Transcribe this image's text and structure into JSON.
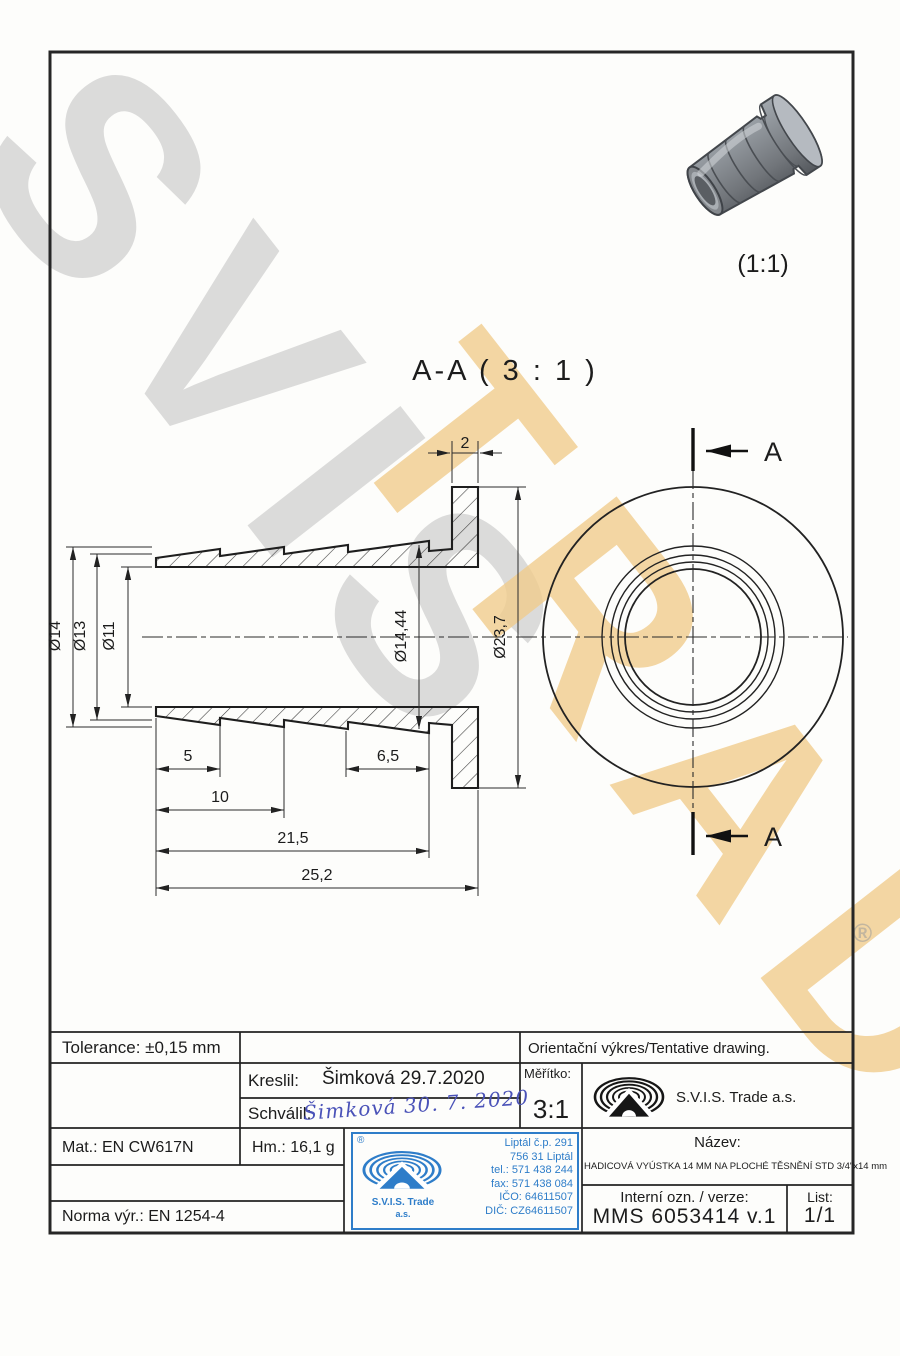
{
  "watermark": {
    "text_primary": "SVIS",
    "text_secondary": "TRADE",
    "registered": "®"
  },
  "views": {
    "section_title": "A-A ( 3 : 1 )",
    "photo_scale": "(1:1)",
    "cut_label_top": "A",
    "cut_label_bottom": "A"
  },
  "dimensions": {
    "flange_thickness": "2",
    "dia_outer": "Ø14",
    "dia_mid": "Ø13",
    "dia_bore": "Ø11",
    "dia_barb": "Ø14,44",
    "dia_flange": "Ø23,7",
    "len_5": "5",
    "len_10": "10",
    "len_6_5": "6,5",
    "len_21_5": "21,5",
    "len_25_2": "25,2"
  },
  "title_block": {
    "tolerance": "Tolerance: ±0,15 mm",
    "orientation_note": "Orientační výkres/Tentative drawing.",
    "kreslil_label": "Kreslil:",
    "kreslil_value": "Šimková 29.7.2020",
    "schvalil_label": "Schválil:",
    "schvalil_signature": "Šimková 30. 7. 2020",
    "meritko_label": "Měřítko:",
    "meritko_value": "3:1",
    "company": "S.V.I.S. Trade a.s.",
    "mat": "Mat.: EN CW617N",
    "hm": "Hm.: 16,1 g",
    "nazev_label": "Název:",
    "nazev_value": "HADICOVÁ VYÚSTKA 14 MM NA PLOCHÉ TĚSNĚNÍ STD 3/4\"x14 mm",
    "interni_label": "Interní ozn. / verze:",
    "interni_value": "MMS 6053414 v.1",
    "list_label": "List:",
    "list_value": "1/1",
    "norma": "Norma výr.: EN 1254-4"
  },
  "stamp": {
    "registered": "®",
    "company_line1": "S.V.I.S. Trade",
    "company_line2": "a.s.",
    "address": [
      "Liptál č.p. 291",
      "756 31 Liptál",
      "tel.: 571 438 244",
      "fax: 571 438 084",
      "IČO: 64611507",
      "DIČ: CZ64611507"
    ]
  }
}
